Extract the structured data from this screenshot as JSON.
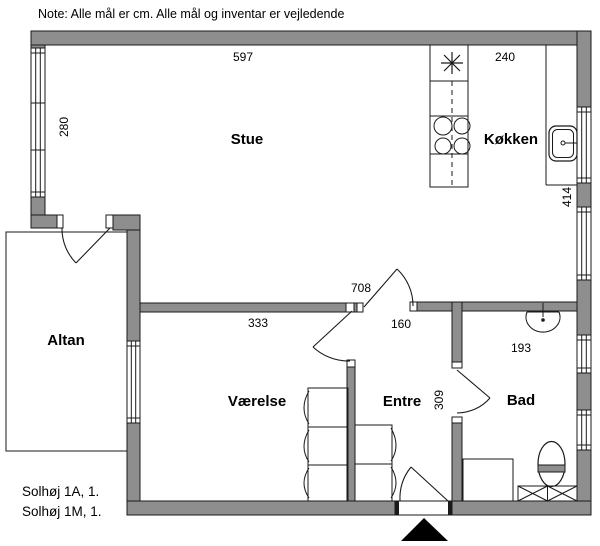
{
  "note": "Note: Alle mål er cm. Alle mål og inventar er vejledende",
  "rooms": {
    "stue": "Stue",
    "kokken": "Køkken",
    "altan": "Altan",
    "vaerelse": "Værelse",
    "entre": "Entre",
    "bad": "Bad"
  },
  "dimensions": {
    "stue_width_cm": "597",
    "kokken_width_cm": "240",
    "stue_window_cm": "280",
    "kokken_length_cm": "414",
    "plan_length_cm": "708",
    "vaerelse_width_cm": "333",
    "entre_width_cm": "160",
    "bad_width_cm": "193",
    "entre_length_cm": "309"
  },
  "footer": {
    "address_1": "Solhøj 1A, 1.",
    "address_2": "Solhøj 1M, 1."
  },
  "colors": {
    "wall": "#8e8e8e",
    "line": "#1a1a1a",
    "background": "#ffffff"
  }
}
